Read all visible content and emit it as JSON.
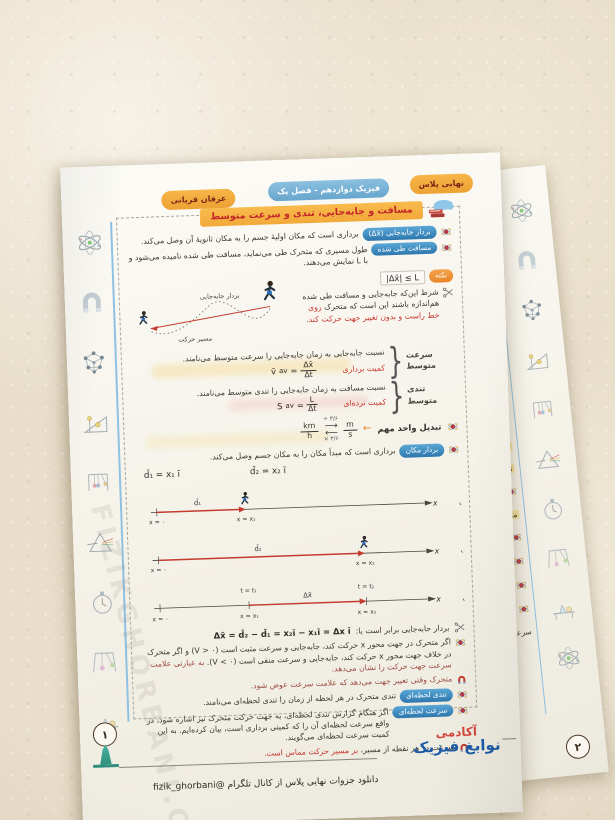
{
  "colors": {
    "accent_orange": "#f0a63c",
    "accent_blue": "#5b9fce",
    "accent_red": "#c4342b",
    "teal": "#2f9e8f",
    "paper": "#f8f5ee"
  },
  "header": {
    "tab_plus": "نهایی پلاس",
    "tab_book": "فیزیک دوازدهم - فصل یک",
    "tab_author": "عرفان قربانی"
  },
  "lesson": {
    "title": "مسافت و جابه‌جایی، تندی و سرعت متوسط",
    "displacement": {
      "label": "بردار جابه‌جایی (Δx̄)",
      "text": "برداری است که مکان اولیهٔ جسم را به مکان ثانویهٔ آن وصل می‌کند."
    },
    "distance": {
      "label": "مسافت طی شده",
      "text": "طول مسیری که متحرک طی می‌نماید، مسافت طی شده نامیده می‌شود و با L نمایش می‌دهند."
    },
    "note": {
      "label": "نکته",
      "formula": "|Δx̄| ≤ L"
    },
    "condition": {
      "text1": "شرط این‌که جابه‌جایی و مسافت طی شده هم‌اندازه باشند این است که متحرک",
      "text2": "روی خط راست و بدون تغییر جهت حرکت کند."
    },
    "curve": {
      "vector_label": "بردار جابه‌جایی",
      "path_label": "مسیر حرکت"
    },
    "avg_velocity": {
      "label": "سرعت متوسط",
      "definition": "نسبت جابه‌جایی به زمان جابه‌جایی را سرعت متوسط می‌نامند.",
      "sym": "v̄",
      "sub": "av",
      "num": "Δx̄",
      "den": "Δt",
      "kind": "کمیت برداری"
    },
    "avg_speed": {
      "label": "تندی متوسط",
      "definition": "نسبت مسافت به زمان جابه‌جایی را تندی متوسط می‌نامند.",
      "sym": "S",
      "sub": "av",
      "num": "L",
      "den": "Δt",
      "kind": "کمیت نرده‌ای"
    },
    "unit_conversion": {
      "label": "تبدیل واحد مهم",
      "from_num": "km",
      "from_den": "h",
      "to_num": "m",
      "to_den": "s",
      "divide": "÷ ۳/۶",
      "multiply": "× ۳/۶"
    },
    "position_vector": {
      "label": "بردار مکان",
      "text": "برداری است که مبدأ مکان را به مکان جسم وصل می‌کند.",
      "d1": "d̄₁ = x₁ ī",
      "d2": "d̄₂ = x₂ ī"
    },
    "axes": {
      "a": {
        "name": "الف",
        "axis": "x",
        "origin": "x = ۰",
        "pos": "x = x₁",
        "vec": "d̄₁"
      },
      "b": {
        "name": "ب",
        "axis": "x",
        "origin": "x = ۰",
        "pos": "x = x₂",
        "vec": "d̄₂"
      },
      "p": {
        "name": "پ",
        "axis": "x",
        "origin": "x = ۰",
        "pos1": "x = x₁",
        "pos2": "x = x₂",
        "t1": "t = t₁",
        "t2": "t = t₂",
        "vec": "Δx̄"
      }
    },
    "displacement_eq": {
      "intro": "بردار جابه‌جایی برابر است با:",
      "formula": "Δx̄ = d̄₂ − d̄₁ = x₂ī − x₁ī = Δx ī"
    },
    "sign_rule": {
      "text1": "اگر متحرک در جهت محور x حرکت کند، جابه‌جایی و سرعت مثبت است (V > ۰) و اگر متحرک در خلاف جهت محور x حرکت کند، جابه‌جایی و سرعت منفی است (V < ۰).",
      "text2": "به عبارتی علامت سرعت جهت حرکت را نشان می‌دهد."
    },
    "direction_note": "متحرک وقتی تغییر جهت می‌دهد که علامت سرعت عوض شود.",
    "inst_speed": {
      "label": "تندی لحظه‌ای",
      "text": "تندی متحرک در هر لحظه از زمان را تندی لحظه‌ای می‌نامند."
    },
    "inst_velocity": {
      "label": "سرعت لحظه‌ای",
      "text": "اگر هنگام گزارش تندی لحظه‌ای، به جهت حرکت متحرک نیز اشاره شود، در واقع سرعت لحظه‌ای آن را که کمیتی برداری است، بیان کرده‌ایم. به این کمیت سرعت لحظه‌ای می‌گویند."
    },
    "tangent_note": {
      "text1": "سرعت در هر نقطه از مسیر،",
      "text2": "بر مسیر حرکت مماس است."
    }
  },
  "footer": {
    "page_number": "۱",
    "logo_line1": "آکادمی",
    "logo_line2": "نوابغ فیزیک",
    "download_text": "دانلود جزوات نهایی پلاس از کانال تلگرام @fizik_ghorbani"
  },
  "watermark": "FIZIKGHORBANI.COM",
  "sheet2": {
    "page_number": "۲",
    "fragments": [
      "در",
      "دو",
      "تندی متوسط که",
      "تندی متوسط با",
      "در چ",
      "متحرک روی خط",
      "در حر",
      "در حرک",
      "در حرکت",
      "اگر در ح",
      "سرعت متوسط از ت"
    ]
  },
  "margin_icons": [
    "atom",
    "horseshoe-magnet",
    "molecule-lattice",
    "inclined-plane",
    "newtons-cradle",
    "prism",
    "stopwatch",
    "pendulum",
    "lab-bench"
  ]
}
